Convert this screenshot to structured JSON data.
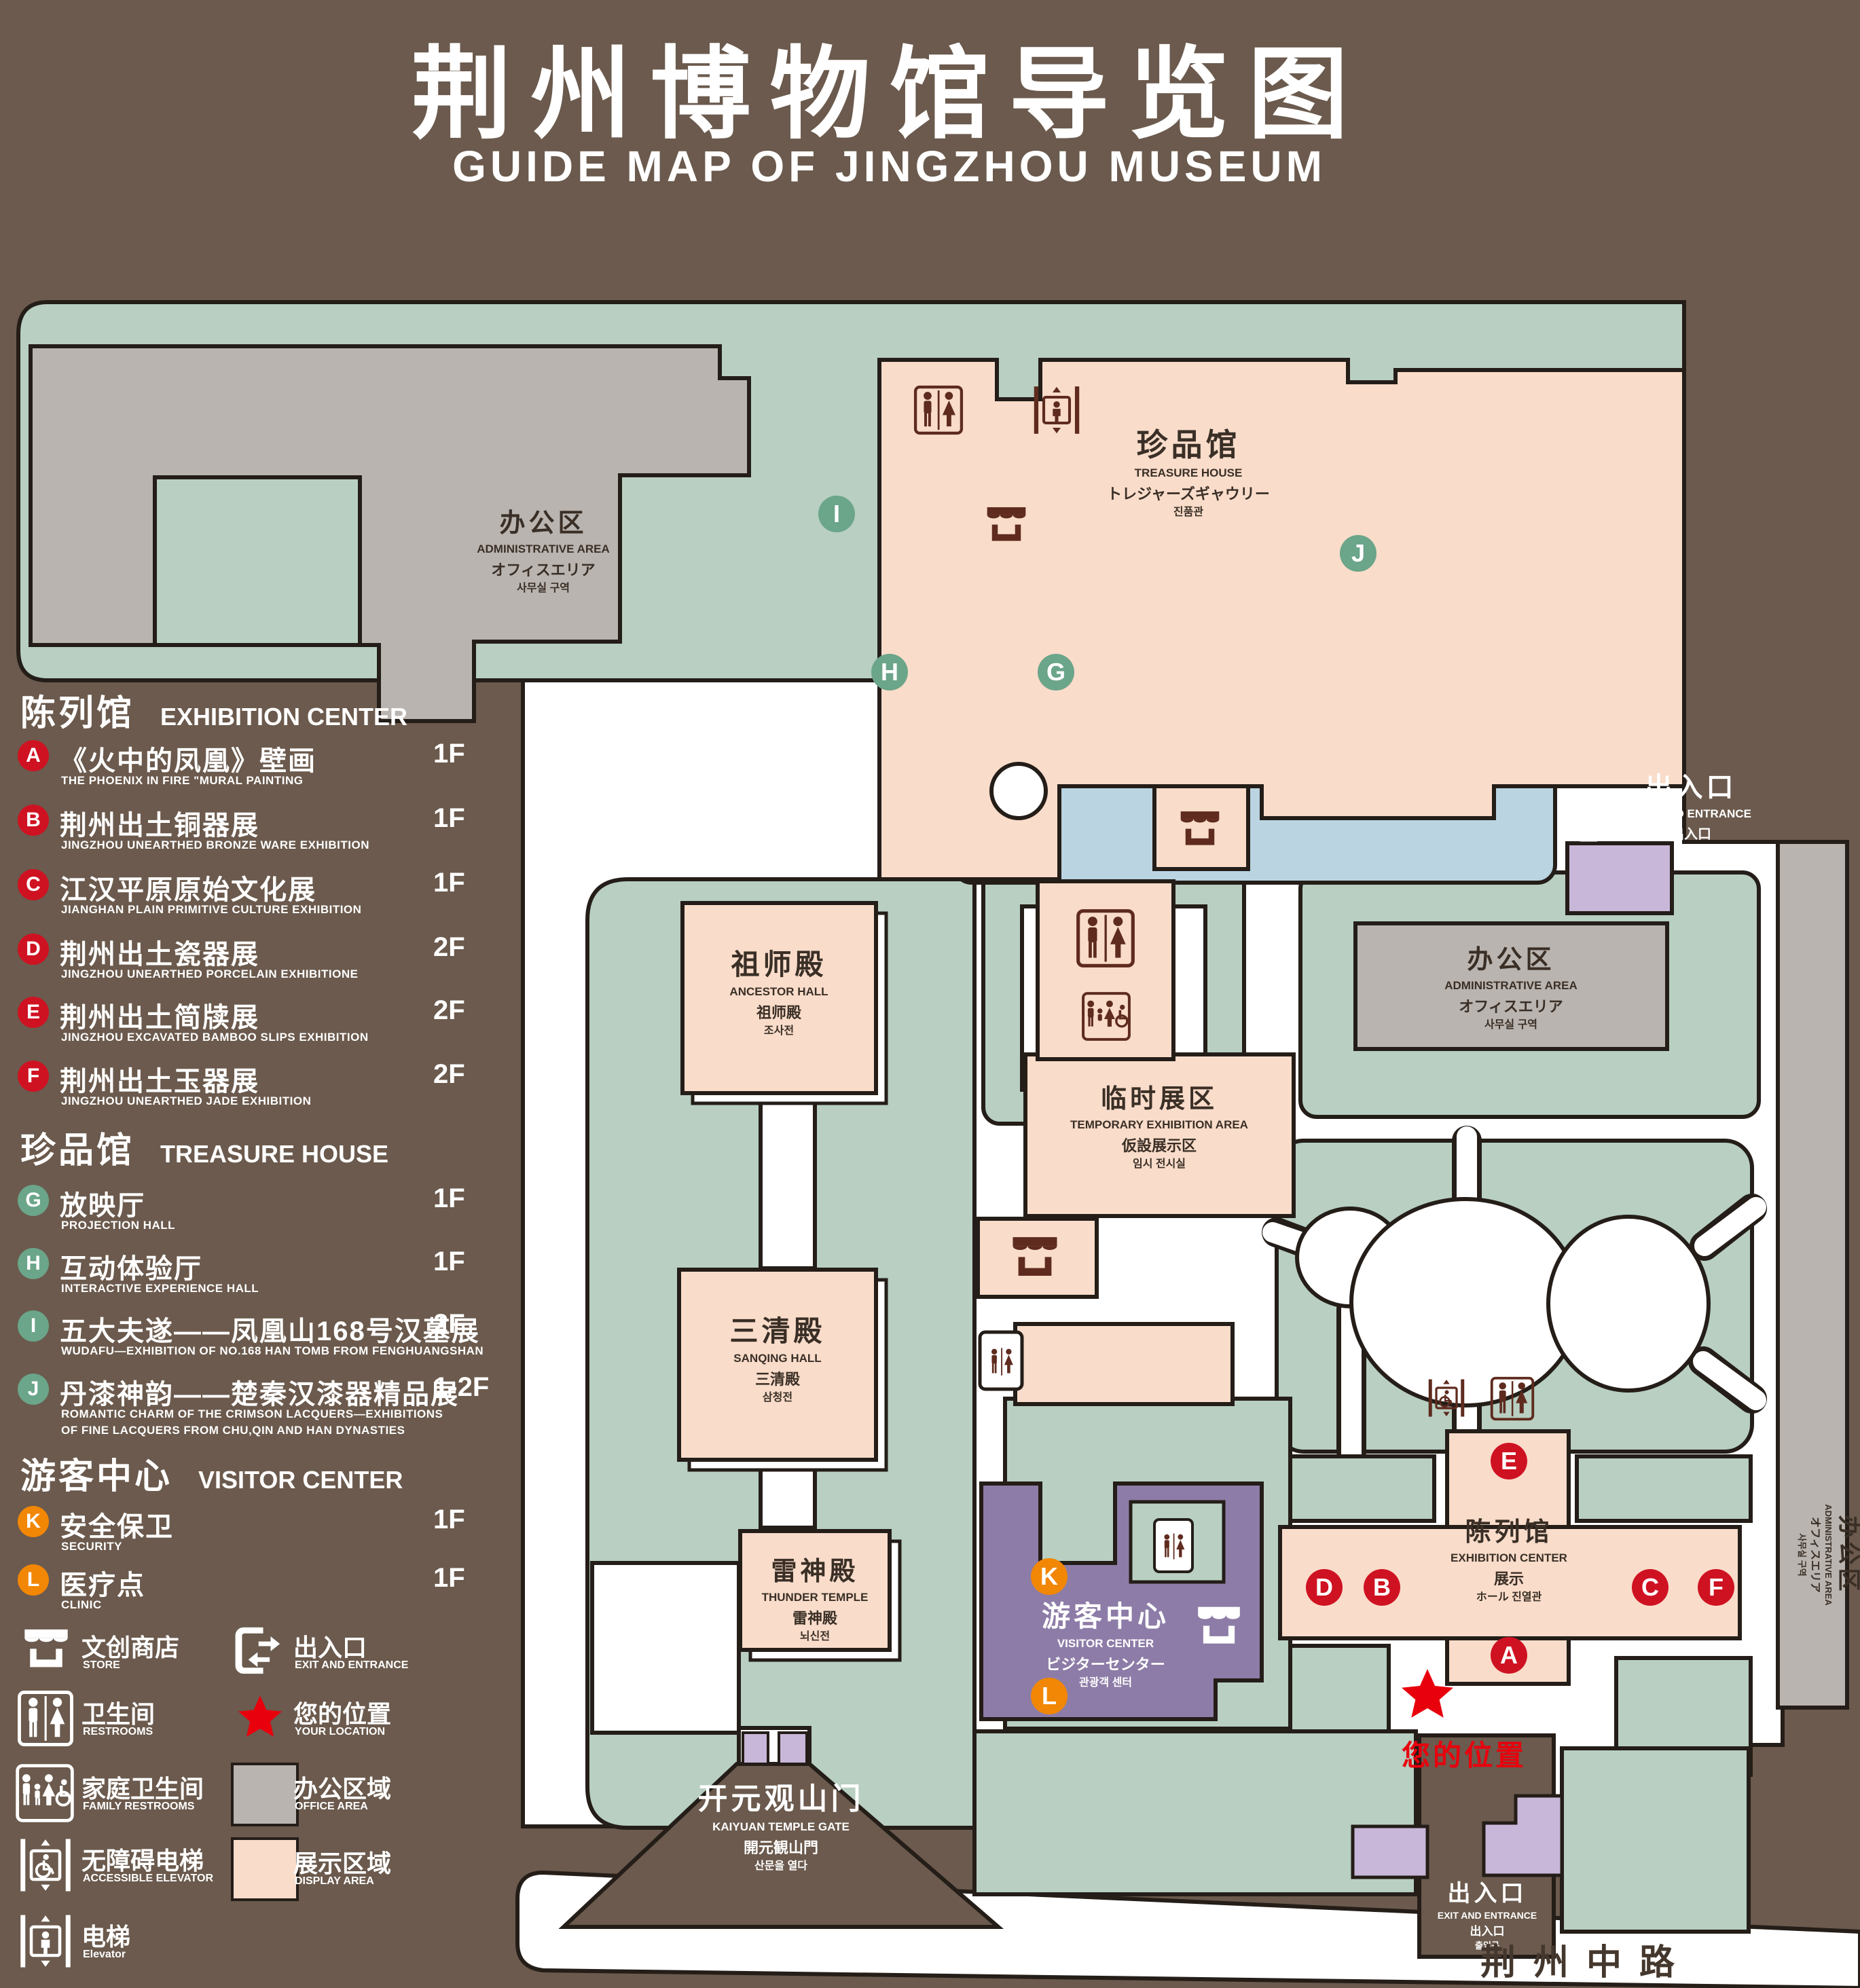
{
  "title": {
    "zh": "荆州博物馆导览图",
    "en": "GUIDE MAP OF JINGZHOU MUSEUM"
  },
  "colors": {
    "background": "#6b5a4d",
    "outline": "#241d18",
    "green_area": "#b8cfc2",
    "office_area": "#bab4b0",
    "display_area": "#f9dcca",
    "water": "#bad4e2",
    "visitor_center_purple": "#8d7ca7",
    "gate_purple": "#c9b7d9",
    "badge_red": "#cf1222",
    "badge_green": "#6ba58a",
    "badge_orange": "#f28705",
    "icon_maroon": "#5e2b1e",
    "location_red": "#e8000d"
  },
  "legend": {
    "sections": [
      {
        "zh": "陈列馆",
        "en": "EXHIBITION CENTER",
        "items": [
          {
            "letter": "A",
            "zh": "《火中的凤凰》壁画",
            "en": "THE PHOENIX IN FIRE \"MURAL PAINTING",
            "floor": "1F"
          },
          {
            "letter": "B",
            "zh": "荆州出土铜器展",
            "en": "JINGZHOU UNEARTHED BRONZE WARE EXHIBITION",
            "floor": "1F"
          },
          {
            "letter": "C",
            "zh": "江汉平原原始文化展",
            "en": "JIANGHAN PLAIN PRIMITIVE CULTURE EXHIBITION",
            "floor": "1F"
          },
          {
            "letter": "D",
            "zh": "荆州出土瓷器展",
            "en": "JINGZHOU UNEARTHED PORCELAIN EXHIBITIONE",
            "floor": "2F"
          },
          {
            "letter": "E",
            "zh": "荆州出土简牍展",
            "en": "JINGZHOU EXCAVATED BAMBOO SLIPS EXHIBITION",
            "floor": "2F"
          },
          {
            "letter": "F",
            "zh": "荆州出土玉器展",
            "en": "JINGZHOU UNEARTHED JADE EXHIBITION",
            "floor": "2F"
          }
        ]
      },
      {
        "zh": "珍品馆",
        "en": "TREASURE HOUSE",
        "items": [
          {
            "letter": "G",
            "zh": "放映厅",
            "en": "PROJECTION HALL",
            "floor": "1F"
          },
          {
            "letter": "H",
            "zh": "互动体验厅",
            "en": "INTERACTIVE EXPERIENCE HALL",
            "floor": "1F"
          },
          {
            "letter": "I",
            "zh": "五大夫遂——凤凰山168号汉墓展",
            "en": "WUDAFU—EXHIBITION OF NO.168 HAN TOMB FROM FENGHUANGSHAN",
            "floor": "2F"
          },
          {
            "letter": "J",
            "zh": "丹漆神韵——楚秦汉漆器精品展",
            "en": "ROMANTIC CHARM OF THE CRIMSON LACQUERS—EXHIBITIONS",
            "en2": "OF FINE LACQUERS FROM CHU,QIN AND HAN DYNASTIES",
            "floor": "1-2F"
          }
        ]
      },
      {
        "zh": "游客中心",
        "en": "VISITOR CENTER",
        "items": [
          {
            "letter": "K",
            "zh": "安全保卫",
            "en": "SECURITY",
            "floor": "1F"
          },
          {
            "letter": "L",
            "zh": "医疗点",
            "en": "CLINIC",
            "floor": "1F"
          }
        ]
      }
    ],
    "symbols": {
      "store": {
        "zh": "文创商店",
        "en": "STORE"
      },
      "restrooms": {
        "zh": "卫生间",
        "en": "RESTROOMS"
      },
      "family": {
        "zh": "家庭卫生间",
        "en": "FAMILY RESTROOMS"
      },
      "accessible": {
        "zh": "无障碍电梯",
        "en": "ACCESSIBLE ELEVATOR"
      },
      "elevator": {
        "zh": "电梯",
        "en": "Elevator"
      },
      "exit": {
        "zh": "出入口",
        "en": "EXIT AND ENTRANCE"
      },
      "location": {
        "zh": "您的位置",
        "en": "YOUR LOCATION"
      },
      "office": {
        "zh": "办公区域",
        "en": "OFFICE AREA"
      },
      "display": {
        "zh": "展示区域",
        "en": "DISPLAY AREA"
      }
    }
  },
  "map": {
    "labels": {
      "admin": {
        "zh": "办公区",
        "en": "ADMINISTRATIVE AREA",
        "ja": "オフィスエリア",
        "ko": "사무실 구역"
      },
      "treasure": {
        "zh": "珍品馆",
        "en": "TREASURE HOUSE",
        "ja": "トレジャーズギャウリー",
        "ko": "진품관"
      },
      "tea": {
        "zh": "临时展区",
        "en": "TEMPORARY EXHIBITION AREA",
        "ja": "仮設展示区",
        "ko": "임시 전시실"
      },
      "ancestor": {
        "zh": "祖师殿",
        "en": "ANCESTOR HALL",
        "ja": "祖师殿",
        "ko": "조사전"
      },
      "sanqing": {
        "zh": "三清殿",
        "en": "SANQING HALL",
        "ja": "三清殿",
        "ko": "삼청전"
      },
      "thunder": {
        "zh": "雷神殿",
        "en": "THUNDER TEMPLE",
        "ja": "雷神殿",
        "ko": "뇌신전"
      },
      "visitor": {
        "zh": "游客中心",
        "en": "VISITOR CENTER",
        "ja": "ビジターセンター",
        "ko": "관광객 센터"
      },
      "exhibition": {
        "zh": "陈列馆",
        "en": "EXHIBITION CENTER",
        "ja": "展示",
        "ko": "ホール 진열관"
      },
      "exit": {
        "zh": "出入口",
        "en": "EXIT AND ENTRANCE",
        "ja": "出入口",
        "ko": "출입구"
      },
      "gate": {
        "zh": "开元观山门",
        "en": "KAIYUAN TEMPLE GATE",
        "ja": "開元観山門",
        "ko": "산문을 열다"
      }
    },
    "road": "荆州中路",
    "your_location": "您的位置",
    "badges": [
      {
        "letter": "I"
      },
      {
        "letter": "J"
      },
      {
        "letter": "H"
      },
      {
        "letter": "G"
      },
      {
        "letter": "E"
      },
      {
        "letter": "D"
      },
      {
        "letter": "B"
      },
      {
        "letter": "C"
      },
      {
        "letter": "F"
      },
      {
        "letter": "A"
      },
      {
        "letter": "K"
      },
      {
        "letter": "L"
      }
    ]
  }
}
